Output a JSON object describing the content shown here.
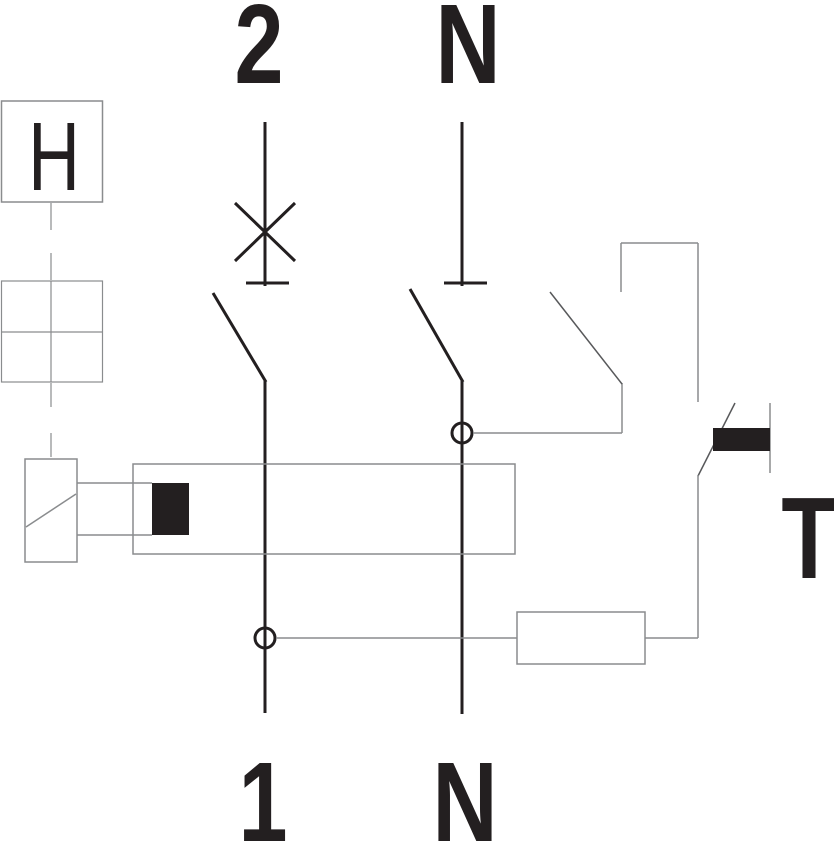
{
  "diagram": {
    "terminals": {
      "top_left": "2",
      "top_right": "N",
      "bottom_left": "1",
      "bottom_right": "N"
    },
    "labels": {
      "aux_module": "H",
      "test_button": "T"
    }
  },
  "colors": {
    "ink": "#231f20",
    "thin_line": "#8a8c8e",
    "dark_thin_line": "#58595b",
    "background": "#ffffff"
  }
}
